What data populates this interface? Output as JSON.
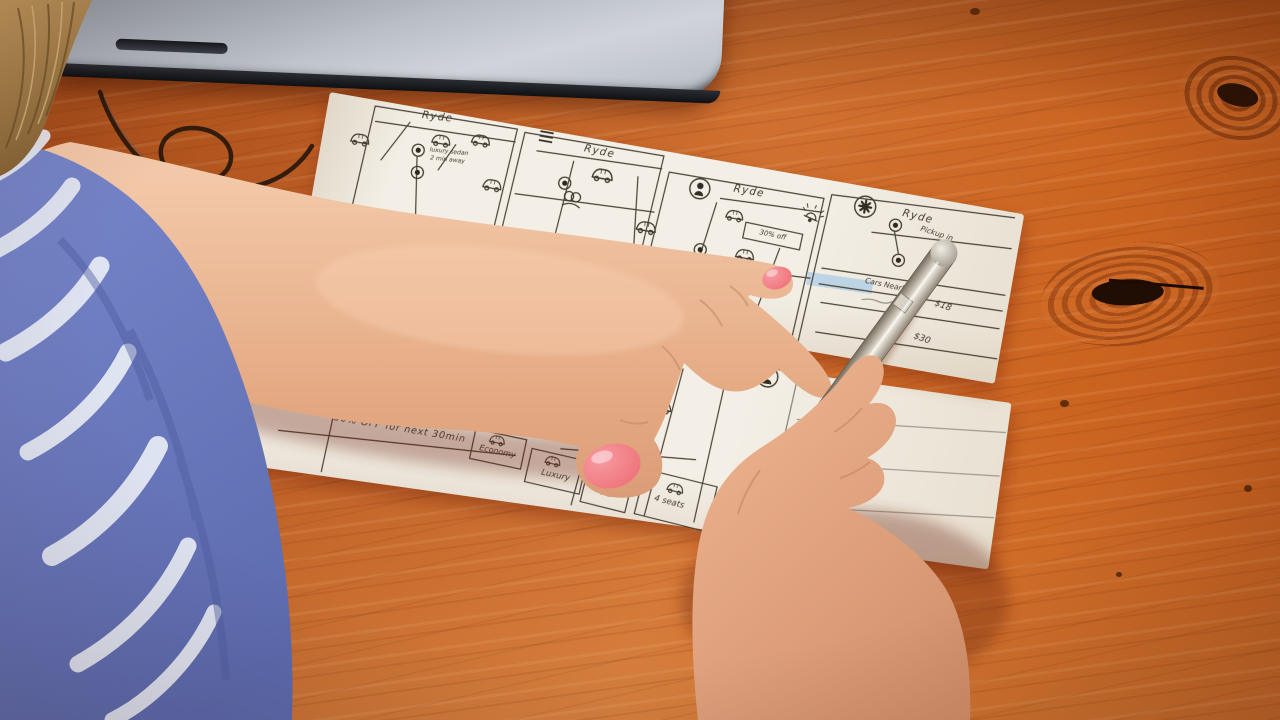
{
  "colors": {
    "wood": "#c2662a",
    "wood_dark": "#9a4716",
    "paper": "#f3efe6",
    "ink": "#423a2e",
    "sleeve_blue": "#6d7cc0",
    "pattern_white": "#e9edf6",
    "skin": "#ecb897",
    "nail_polish": "#f3797f",
    "laptop_silver": "#b9bec6",
    "pen_silver": "#cfc8ba",
    "highlight_blue": "#a7cbe7"
  },
  "sheet1": {
    "panelA": {
      "title": "Ryde",
      "pin_note_1": "luxury sedan",
      "pin_note_2": "2 min away"
    },
    "panelB": {
      "title": "Ryde"
    },
    "panelC": {
      "title": "Ryde",
      "promo": "30% off"
    },
    "panelD": {
      "title": "Ryde",
      "pickup_note": "Pickup in",
      "list_header": "Cars Nearby",
      "fare_1": "$18",
      "fare_2": "$30"
    }
  },
  "sheet2": {
    "pin_note_1": "luxury",
    "pin_note_2": "sedan",
    "pin_note_3": "2 min.",
    "pin_note_4": "away",
    "schedule_note": "w/ 6pm",
    "promo_banner": "30% OFF for next 30min",
    "destinations": {
      "search": "Enter location",
      "row_home": "Home",
      "row_work": "Work",
      "recent_name": "Safeway",
      "recent_city": "San Francisco, CA"
    },
    "tiers": {
      "t1": "Economy",
      "t2": "Luxury",
      "t3": "XL"
    },
    "capacity_note": "4 seats"
  }
}
